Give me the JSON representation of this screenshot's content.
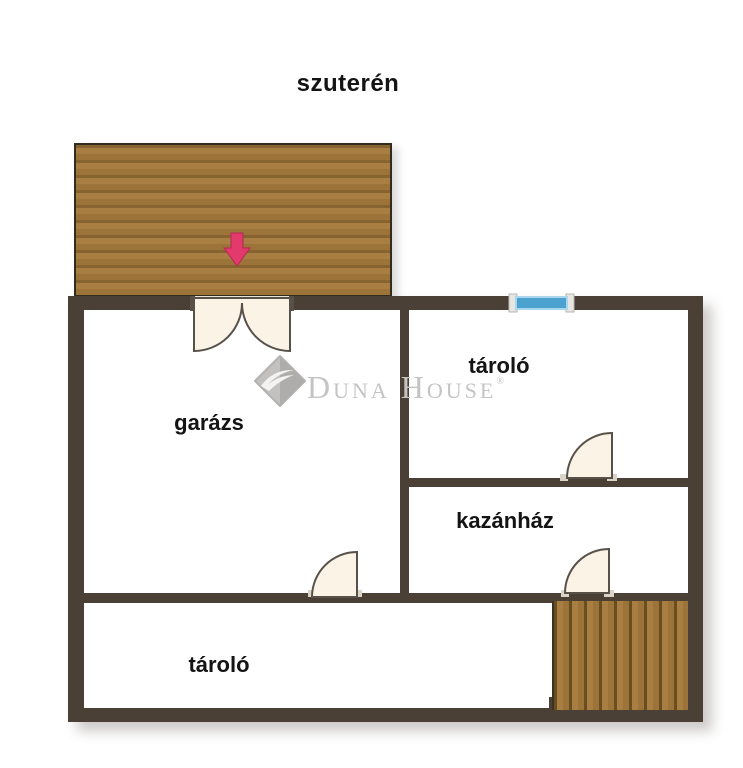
{
  "title": "szuterén",
  "rooms": {
    "garage": {
      "label": "garázs"
    },
    "storage_upper": {
      "label": "tároló"
    },
    "boiler": {
      "label": "kazánház"
    },
    "storage_lower": {
      "label": "tároló"
    }
  },
  "watermark": {
    "brand": "Duna House",
    "registered_mark": "®"
  },
  "icons": {
    "ramp": "driveway-ramp-icon",
    "arrow": "entrance-down-arrow-icon",
    "window": "window-marker-icon",
    "stairs": "stairs-icon",
    "doors": [
      "garage-double-door-icon",
      "storage-door-icon",
      "garage-door-icon",
      "boiler-door-icon"
    ],
    "logo": "duna-house-logo-icon"
  },
  "colors": {
    "wall": "#4b4035",
    "wood_plank": "#a87e42",
    "wood_groove": "#87642f",
    "door_fill": "#faf3e6",
    "door_stroke": "#57514a",
    "door_opening_band": "#e9e2d6",
    "window_blue": "#4ba2cf",
    "window_cap": "#e8e6e1",
    "arrow_pink": "#e23a6d",
    "watermark_gray": "#c5c4c3",
    "label_black": "#141414"
  }
}
